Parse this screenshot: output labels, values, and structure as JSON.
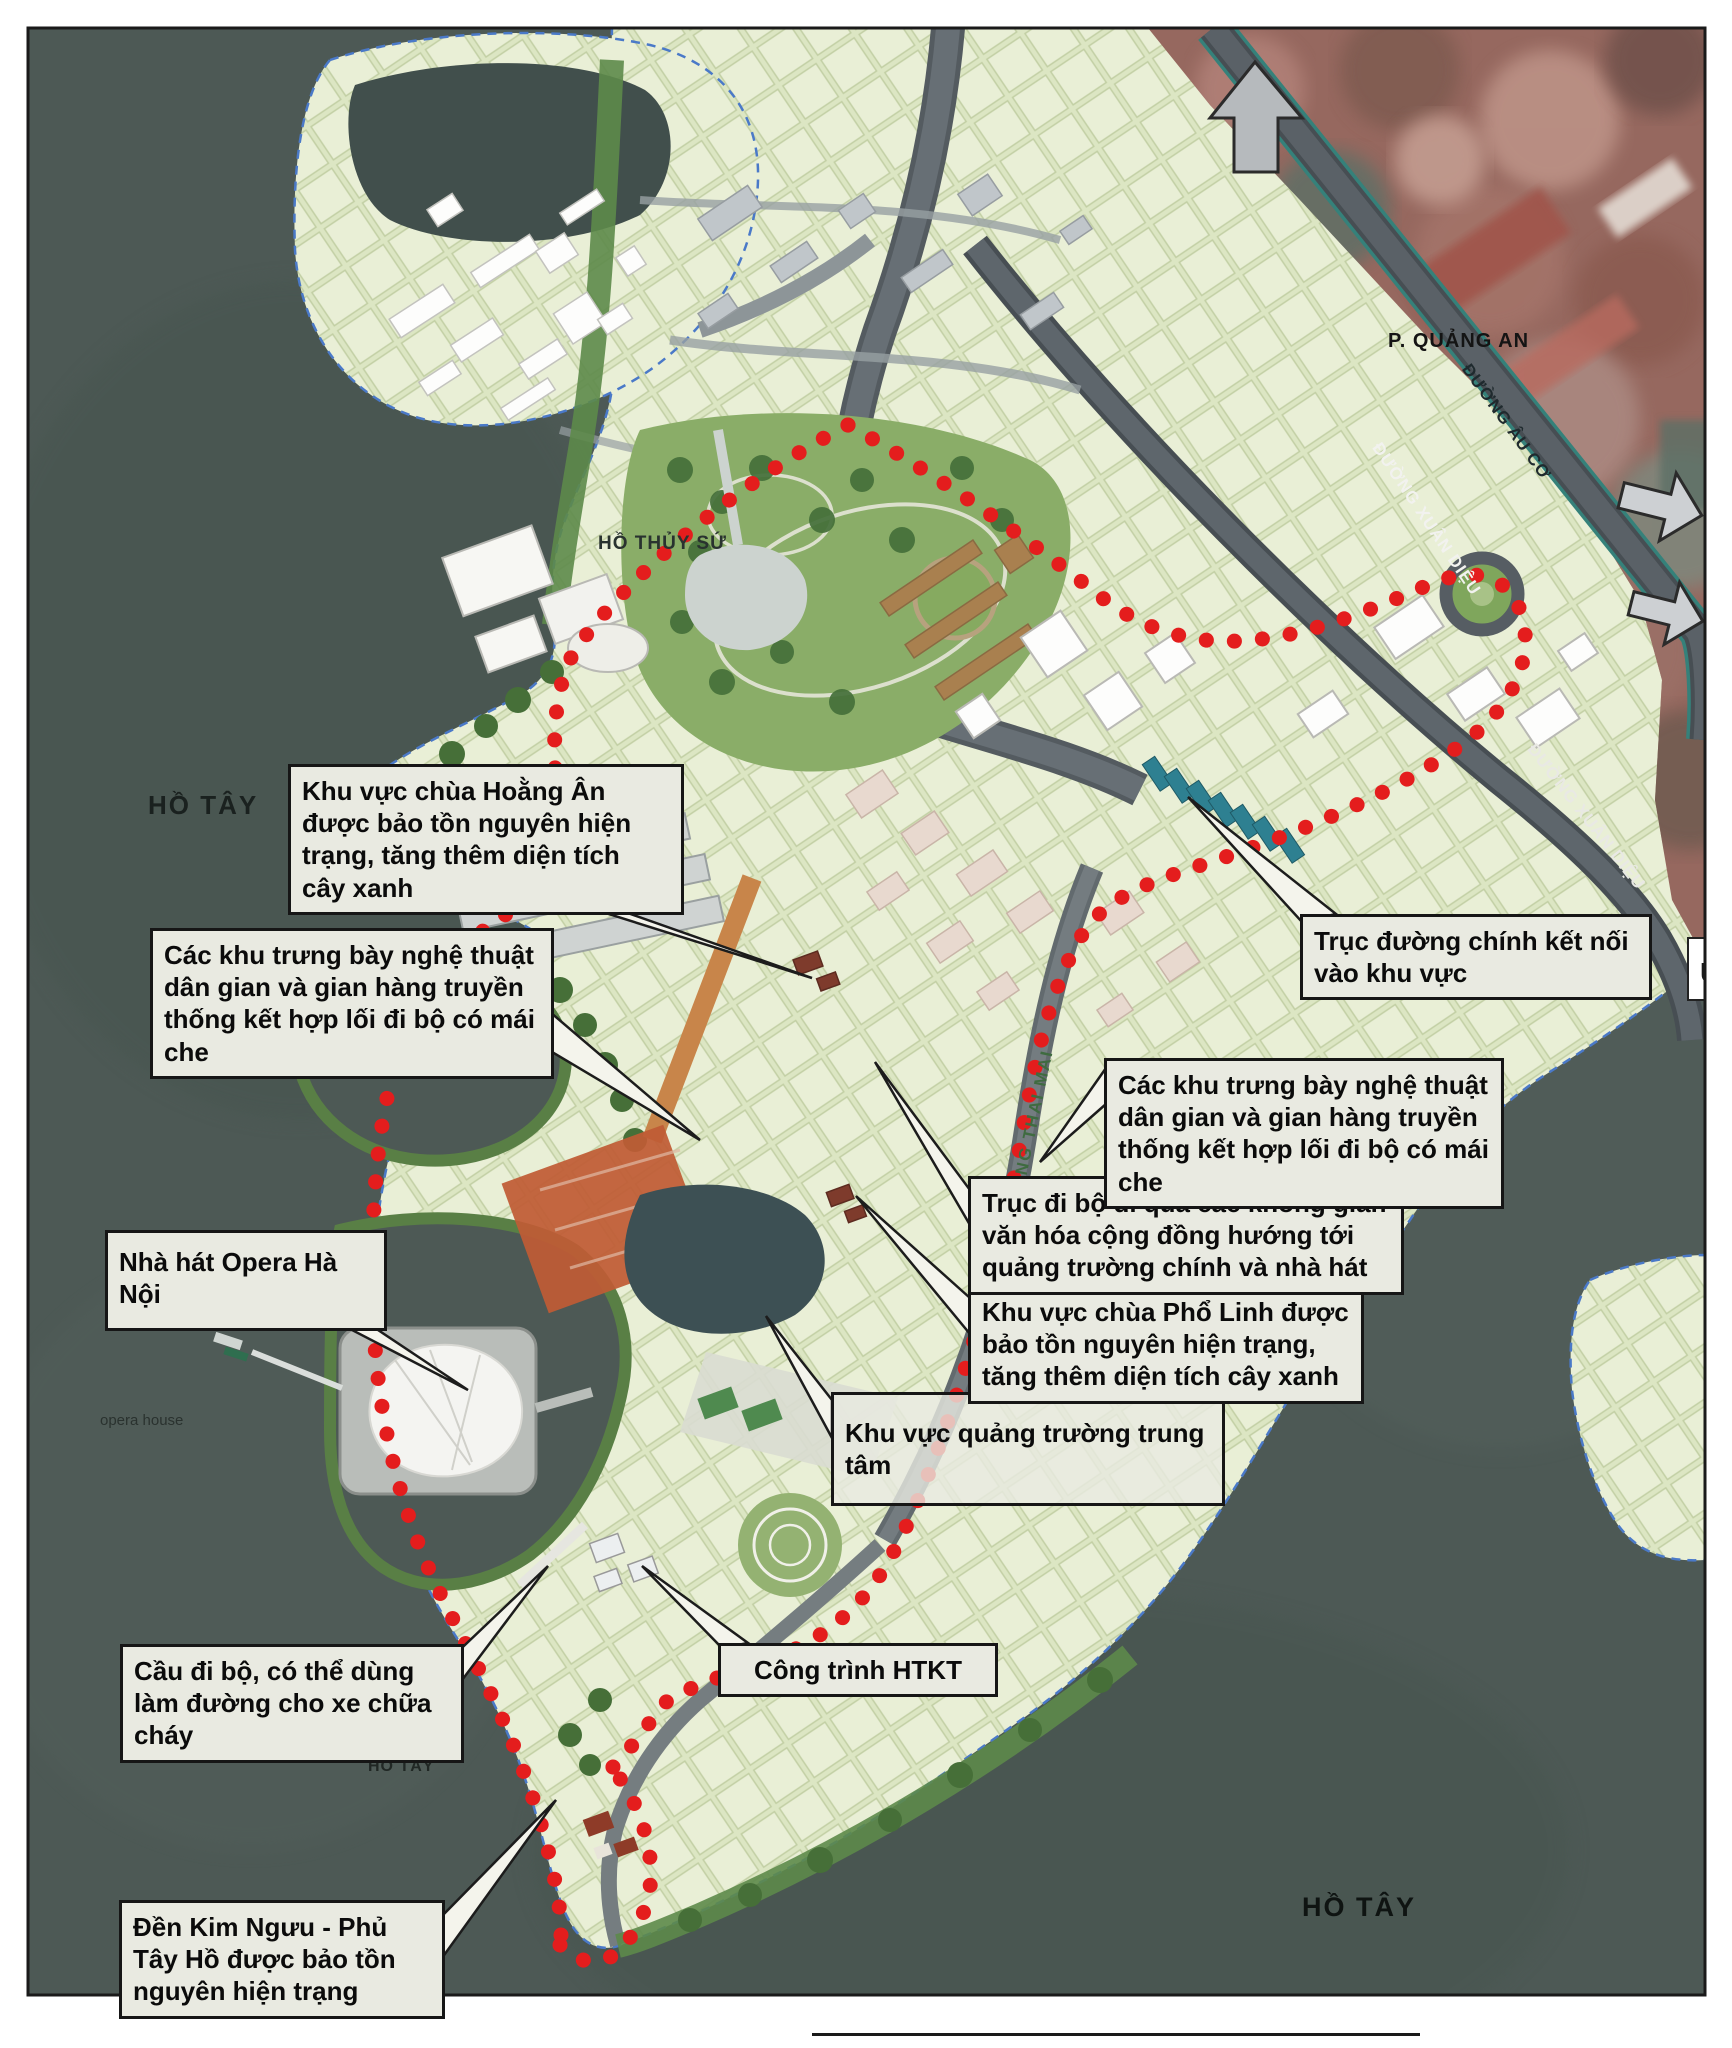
{
  "callouts": [
    {
      "id": "chua-hoang-an",
      "text": "Khu vực chùa Hoằng Ân được bảo tồn nguyên hiện trạng, tăng thêm diện tích cây xanh"
    },
    {
      "id": "trung-bay-left",
      "text": "Các khu trưng bày nghệ thuật dân gian và gian hàng truyền thống kết hợp lối đi bộ có mái che"
    },
    {
      "id": "opera",
      "text": "Nhà hát Opera Hà Nội"
    },
    {
      "id": "cau-di-bo",
      "text": "Cầu đi bộ, có thể dùng làm đường cho xe chữa cháy"
    },
    {
      "id": "den-kim-nguu",
      "text": "Đền Kim Ngưu - Phủ Tây Hồ được bảo tồn nguyên hiện trạng"
    },
    {
      "id": "cong-trinh-htkt",
      "text": "Công trình HTKT"
    },
    {
      "id": "quang-truong",
      "text": "Khu vực quảng trường trung tâm"
    },
    {
      "id": "chua-pho-linh",
      "text": "Khu vực chùa Phổ Linh được bảo tồn nguyên hiện trạng, tăng thêm diện tích cây xanh"
    },
    {
      "id": "truc-di-bo",
      "text": "Trục đi bộ đi qua các không gian văn hóa cộng đồng hướng tới quảng trường chính và nhà hát"
    },
    {
      "id": "trung-bay-right",
      "text": "Các khu trưng bày nghệ thuật dân gian và gian hàng truyền thống kết hợp lối đi bộ có mái che"
    },
    {
      "id": "truc-duong-chinh",
      "text": "Trục đường chính kết nối vào khu vực"
    }
  ],
  "labels": {
    "ho_tay_left": "HỒ TÂY",
    "ho_thuy_su": "HỒ THỦY SỨ",
    "quang_an": "P. QUẢNG AN",
    "opera_house": "opera house",
    "ho_tay_small": "HỒ TÂY",
    "ho_tay_right": "HỒ TÂY"
  },
  "roads": {
    "au_co": "ĐƯỜNG ÂU CƠ",
    "xuan_dieu_upper": "ĐƯỜNG XUÂN DIỆU",
    "xuan_dieu_lower": "ĐƯỜNG XUÂN DIỆU",
    "dang_thai_mai": "ĐƯỜNG ĐẶNG THAI MAI",
    "edge_partial": "U"
  },
  "colors": {
    "water": "#4d5955",
    "land_block": "#e6edd2",
    "park": "#8aad68",
    "boundary_red": "#e41d1d",
    "box_bg": "#e9eae1",
    "box_border": "#161616",
    "road": "#5a6167",
    "satellite": "#96685f"
  }
}
